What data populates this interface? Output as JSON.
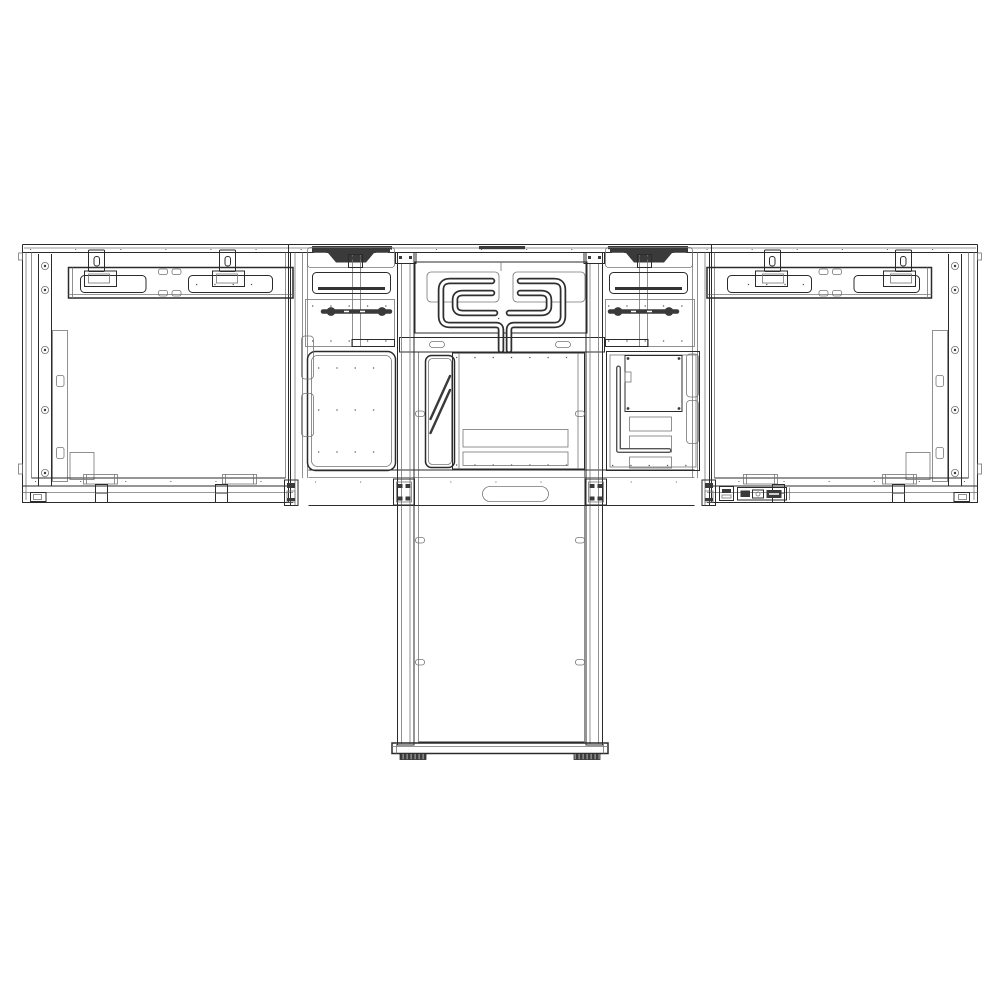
{
  "meta": {
    "title": "Technical line drawing, rear view: dual large-format display video wall on a motorized floor-stand lift column with base plate and leveling feet",
    "drawing_style": "monochrome CAD outline",
    "background_color": "#ffffff"
  },
  "colors": {
    "line": "#2b2b2b",
    "line_light": "#757575",
    "fill_dark": "#3a3a3a",
    "perforation": "#8e8e8e",
    "background": "#ffffff"
  },
  "assembly": {
    "description": "Rear elevation of two display panels mounted side-by-side on a center electronics bay; a twin-leg lift column runs down to a floor base plate with two leveling feet.",
    "counts": {
      "display_panels": 2,
      "hanger_tabs_per_panel": 2,
      "screw_holes_per_edge_strip": 5,
      "handle_recesses": 2,
      "cable_loops": 2,
      "vent_strips_center": 2,
      "hatched_vent_patches_right_bay": 3,
      "column_legs": 2,
      "leg_slot_cutouts_per_leg": 3,
      "leveling_feet": 2
    },
    "components": [
      {
        "name": "top-trim-rail",
        "description": "Thin full-width rail across the top of both panels and center bay"
      },
      {
        "name": "left-display-panel",
        "description": "Left display rear shell with edge screw strip, service bracket, mounting bar with keyhole slots and hanger tabs, bottom brackets"
      },
      {
        "name": "right-display-panel",
        "description": "Mirror of left panel plus AC/IO connector strip at the bottom edge"
      },
      {
        "name": "center-bay",
        "description": "Center electronics bay with two recessed handles, slot frames, connector rods, cable-management loops and vent grilles"
      },
      {
        "name": "cable-loops",
        "description": "Two thick cable tubes looping from the upper slot frames down to the center drop"
      },
      {
        "name": "lift-column",
        "description": "Two vertical legs with oval cutouts flanking a blank back panel"
      },
      {
        "name": "base-plate",
        "description": "Horizontal floor plate under the column"
      },
      {
        "name": "leveling-feet",
        "description": "Two dark ribbed feet under the base plate"
      }
    ]
  }
}
